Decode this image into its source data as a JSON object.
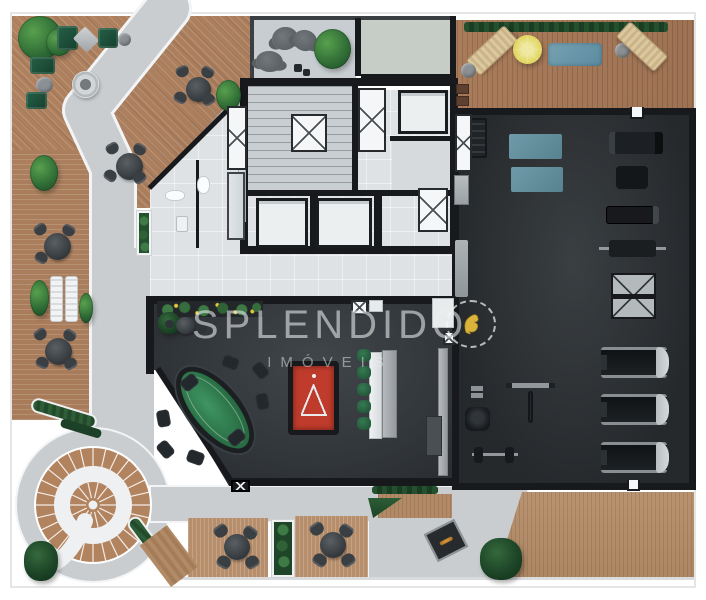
{
  "watermark": {
    "title": "SPLENDIDO",
    "subtitle": "IMÓVEIS"
  },
  "palette": {
    "wood": "#ad8160",
    "path_gray": "#c9cdcf",
    "path_edge": "#f2f4f5",
    "floor_light": "#dfe3e5",
    "wall_black": "#17191c",
    "gym_floor": "#2c3134",
    "game_floor": "#35393d",
    "mat_blue": "#6b98a8",
    "pool_red": "#bf3b2b",
    "poker_green": "#2f7d4e",
    "stool_green": "#2c6445",
    "parasol_yellow": "#e5dd6d",
    "logo_gold": "#d9b33c",
    "hedge_green": "#2a5733",
    "water_blue": "#76a2b2"
  },
  "sprites": [
    {
      "t": "plant",
      "x": 18,
      "y": 16,
      "w": 44,
      "h": 44
    },
    {
      "t": "plant",
      "x": 46,
      "y": 28,
      "w": 26,
      "h": 28
    },
    {
      "t": "chair-green",
      "x": 57,
      "y": 26,
      "w": 21,
      "h": 24
    },
    {
      "t": "pouf-d",
      "x": 76,
      "y": 31,
      "w": 20,
      "h": 17,
      "r": 45
    },
    {
      "t": "chair-green",
      "x": 98,
      "y": 28,
      "w": 20,
      "h": 20
    },
    {
      "t": "pouf",
      "x": 118,
      "y": 33,
      "w": 13,
      "h": 13
    },
    {
      "t": "chair-green",
      "x": 30,
      "y": 57,
      "w": 25,
      "h": 17
    },
    {
      "t": "pouf",
      "x": 36,
      "y": 77,
      "w": 17,
      "h": 16
    },
    {
      "t": "chair-green",
      "x": 26,
      "y": 92,
      "w": 21,
      "h": 17
    },
    {
      "t": "firering",
      "x": 72,
      "y": 71,
      "w": 27,
      "h": 27
    },
    {
      "t": "table-dark",
      "x": 186,
      "y": 77,
      "w": 25,
      "h": 25
    },
    {
      "t": "chair-dark",
      "x": 176,
      "y": 66,
      "w": 13,
      "h": 11,
      "r": -25
    },
    {
      "t": "chair-dark",
      "x": 201,
      "y": 67,
      "w": 13,
      "h": 11,
      "r": 30
    },
    {
      "t": "chair-dark",
      "x": 174,
      "y": 92,
      "w": 13,
      "h": 11,
      "r": 210
    },
    {
      "t": "chair-dark",
      "x": 202,
      "y": 94,
      "w": 13,
      "h": 11,
      "r": 150
    },
    {
      "t": "plant",
      "x": 216,
      "y": 80,
      "w": 25,
      "h": 31
    },
    {
      "t": "table-dark",
      "x": 116,
      "y": 153,
      "w": 27,
      "h": 27
    },
    {
      "t": "chair-dark",
      "x": 106,
      "y": 143,
      "w": 13,
      "h": 11,
      "r": -30
    },
    {
      "t": "chair-dark",
      "x": 133,
      "y": 144,
      "w": 13,
      "h": 11,
      "r": 30
    },
    {
      "t": "chair-dark",
      "x": 104,
      "y": 170,
      "w": 13,
      "h": 11,
      "r": 215
    },
    {
      "t": "chair-dark",
      "x": 133,
      "y": 172,
      "w": 13,
      "h": 11,
      "r": 145
    },
    {
      "t": "plant",
      "x": 30,
      "y": 155,
      "w": 28,
      "h": 36
    },
    {
      "t": "table-dark",
      "x": 44,
      "y": 233,
      "w": 27,
      "h": 27
    },
    {
      "t": "chair-dark",
      "x": 34,
      "y": 224,
      "w": 13,
      "h": 11,
      "r": -35
    },
    {
      "t": "chair-dark",
      "x": 62,
      "y": 225,
      "w": 13,
      "h": 11,
      "r": 30
    },
    {
      "t": "chair-dark",
      "x": 35,
      "y": 252,
      "w": 13,
      "h": 11,
      "r": 210
    },
    {
      "t": "plant",
      "x": 30,
      "y": 280,
      "w": 19,
      "h": 36
    },
    {
      "t": "lounger-w",
      "x": 50,
      "y": 276,
      "w": 13,
      "h": 46
    },
    {
      "t": "lounger-w",
      "x": 65,
      "y": 276,
      "w": 13,
      "h": 46
    },
    {
      "t": "plant",
      "x": 79,
      "y": 293,
      "w": 14,
      "h": 30
    },
    {
      "t": "table-dark",
      "x": 45,
      "y": 338,
      "w": 27,
      "h": 27
    },
    {
      "t": "chair-dark",
      "x": 34,
      "y": 329,
      "w": 13,
      "h": 11,
      "r": -35
    },
    {
      "t": "chair-dark",
      "x": 63,
      "y": 330,
      "w": 13,
      "h": 11,
      "r": 35
    },
    {
      "t": "chair-dark",
      "x": 36,
      "y": 357,
      "w": 13,
      "h": 11,
      "r": 205
    },
    {
      "t": "chair-dark",
      "x": 64,
      "y": 358,
      "w": 13,
      "h": 11,
      "r": 150
    },
    {
      "t": "hedge-planter",
      "x": 136,
      "y": 210,
      "w": 16,
      "h": 46
    },
    {
      "t": "chair-round",
      "x": 272,
      "y": 27,
      "w": 26,
      "h": 23,
      "r": -10
    },
    {
      "t": "chair-round",
      "x": 293,
      "y": 30,
      "w": 24,
      "h": 21,
      "r": 15
    },
    {
      "t": "chair-round",
      "x": 256,
      "y": 51,
      "w": 27,
      "h": 21,
      "r": 5
    },
    {
      "t": "plant",
      "x": 314,
      "y": 29,
      "w": 37,
      "h": 40
    },
    {
      "t": "dot-dark",
      "x": 294,
      "y": 64,
      "w": 8,
      "h": 8
    },
    {
      "t": "dot-dark",
      "x": 303,
      "y": 69,
      "w": 7,
      "h": 7
    },
    {
      "t": "hedge-strip",
      "x": 464,
      "y": 22,
      "w": 204,
      "h": 10
    },
    {
      "t": "lounger-beige",
      "x": 466,
      "y": 40,
      "w": 52,
      "h": 21,
      "r": -43
    },
    {
      "t": "pouf",
      "x": 461,
      "y": 63,
      "w": 15,
      "h": 15
    },
    {
      "t": "parasol",
      "x": 513,
      "y": 35,
      "w": 29,
      "h": 29
    },
    {
      "t": "mat-pool",
      "x": 548,
      "y": 43,
      "w": 54,
      "h": 23
    },
    {
      "t": "pouf",
      "x": 615,
      "y": 43,
      "w": 15,
      "h": 15
    },
    {
      "t": "lounger-beige",
      "x": 616,
      "y": 36,
      "w": 52,
      "h": 21,
      "r": 43
    },
    {
      "t": "matbrown",
      "x": 456,
      "y": 84,
      "w": 13,
      "h": 10
    },
    {
      "t": "matbrown",
      "x": 456,
      "y": 96,
      "w": 13,
      "h": 10
    },
    {
      "t": "rack-dumbbell",
      "x": 459,
      "y": 118,
      "w": 28,
      "h": 40
    },
    {
      "t": "mat-blue",
      "x": 509,
      "y": 134,
      "w": 53,
      "h": 25
    },
    {
      "t": "mat-blue",
      "x": 511,
      "y": 167,
      "w": 52,
      "h": 25
    },
    {
      "t": "xbox",
      "x": 455,
      "y": 114,
      "w": 17,
      "h": 58
    },
    {
      "t": "cabinet",
      "x": 454,
      "y": 175,
      "w": 15,
      "h": 30
    },
    {
      "t": "bench-wall",
      "x": 455,
      "y": 240,
      "w": 13,
      "h": 57
    },
    {
      "t": "machine-a",
      "x": 609,
      "y": 132,
      "w": 54,
      "h": 22
    },
    {
      "t": "machine-b",
      "x": 616,
      "y": 166,
      "w": 32,
      "h": 23
    },
    {
      "t": "rower",
      "x": 606,
      "y": 206,
      "w": 53,
      "h": 18
    },
    {
      "t": "benchpress",
      "x": 599,
      "y": 234,
      "w": 67,
      "h": 29
    },
    {
      "t": "elliptical",
      "x": 611,
      "y": 273,
      "w": 45,
      "h": 46
    },
    {
      "t": "treadmill",
      "x": 601,
      "y": 347,
      "w": 66,
      "h": 31
    },
    {
      "t": "treadmill",
      "x": 601,
      "y": 394,
      "w": 66,
      "h": 31
    },
    {
      "t": "treadmill",
      "x": 601,
      "y": 442,
      "w": 66,
      "h": 31
    },
    {
      "t": "rack-t",
      "x": 506,
      "y": 381,
      "w": 49,
      "h": 46
    },
    {
      "t": "db",
      "x": 467,
      "y": 386,
      "w": 20,
      "h": 5
    },
    {
      "t": "db",
      "x": 467,
      "y": 393,
      "w": 20,
      "h": 5
    },
    {
      "t": "machine-c",
      "x": 465,
      "y": 407,
      "w": 25,
      "h": 24
    },
    {
      "t": "barbell-bench",
      "x": 472,
      "y": 440,
      "w": 46,
      "h": 29
    },
    {
      "t": "door-notch",
      "x": 630,
      "y": 107,
      "w": 14,
      "h": 12
    },
    {
      "t": "door-notch",
      "x": 627,
      "y": 480,
      "w": 13,
      "h": 11
    },
    {
      "t": "planter-strip",
      "x": 157,
      "y": 301,
      "w": 106,
      "h": 16
    },
    {
      "t": "plant-dark",
      "x": 158,
      "y": 312,
      "w": 22,
      "h": 22
    },
    {
      "t": "table-dark",
      "x": 176,
      "y": 317,
      "w": 19,
      "h": 17
    },
    {
      "t": "stool-dark",
      "x": 165,
      "y": 320,
      "w": 9,
      "h": 8
    },
    {
      "t": "stool-dark",
      "x": 197,
      "y": 324,
      "w": 10,
      "h": 9
    },
    {
      "t": "poker-table",
      "x": 189,
      "y": 358,
      "w": 52,
      "h": 104,
      "r": -40
    },
    {
      "t": "chair-dark2",
      "x": 252,
      "y": 364,
      "w": 17,
      "h": 13,
      "r": 50
    },
    {
      "t": "chair-dark2",
      "x": 254,
      "y": 395,
      "w": 17,
      "h": 13,
      "r": 80
    },
    {
      "t": "chair-dark2",
      "x": 228,
      "y": 431,
      "w": 17,
      "h": 13,
      "r": 140
    },
    {
      "t": "chair-dark2",
      "x": 187,
      "y": 451,
      "w": 17,
      "h": 13,
      "r": 200
    },
    {
      "t": "chair-dark2",
      "x": 157,
      "y": 443,
      "w": 17,
      "h": 13,
      "r": 230
    },
    {
      "t": "chair-dark2",
      "x": 155,
      "y": 412,
      "w": 17,
      "h": 13,
      "r": 260
    },
    {
      "t": "chair-dark2",
      "x": 181,
      "y": 376,
      "w": 17,
      "h": 13,
      "r": 320
    },
    {
      "t": "chair-dark2",
      "x": 222,
      "y": 356,
      "w": 17,
      "h": 13,
      "r": 20
    },
    {
      "t": "pool-table",
      "x": 288,
      "y": 361,
      "w": 51,
      "h": 74
    },
    {
      "t": "counter-light",
      "x": 369,
      "y": 352,
      "w": 13,
      "h": 87
    },
    {
      "t": "counter-gray",
      "x": 382,
      "y": 350,
      "w": 15,
      "h": 88
    },
    {
      "t": "stool-green",
      "x": 357,
      "y": 349,
      "w": 14,
      "h": 13
    },
    {
      "t": "stool-green",
      "x": 357,
      "y": 366,
      "w": 14,
      "h": 13
    },
    {
      "t": "stool-green",
      "x": 357,
      "y": 383,
      "w": 14,
      "h": 13
    },
    {
      "t": "stool-green",
      "x": 357,
      "y": 400,
      "w": 14,
      "h": 13
    },
    {
      "t": "stool-green",
      "x": 357,
      "y": 417,
      "w": 14,
      "h": 13
    },
    {
      "t": "xbox",
      "x": 351,
      "y": 300,
      "w": 17,
      "h": 15
    },
    {
      "t": "lightbox",
      "x": 369,
      "y": 300,
      "w": 14,
      "h": 12
    },
    {
      "t": "lightbox",
      "x": 432,
      "y": 298,
      "w": 22,
      "h": 30
    },
    {
      "t": "xbox",
      "x": 443,
      "y": 331,
      "w": 12,
      "h": 14
    },
    {
      "t": "counter-gray",
      "x": 438,
      "y": 348,
      "w": 10,
      "h": 128
    },
    {
      "t": "sideboard",
      "x": 426,
      "y": 416,
      "w": 16,
      "h": 40
    },
    {
      "t": "xbox-dark",
      "x": 231,
      "y": 480,
      "w": 19,
      "h": 12
    },
    {
      "t": "hedge",
      "x": 30,
      "y": 406,
      "w": 68,
      "h": 15,
      "r": 17
    },
    {
      "t": "hedge-dark",
      "x": 60,
      "y": 424,
      "w": 42,
      "h": 9,
      "r": 17
    },
    {
      "t": "hedge",
      "x": 142,
      "y": 512,
      "w": 15,
      "h": 62,
      "r": -37
    },
    {
      "t": "wood-piece",
      "x": 152,
      "y": 530,
      "w": 34,
      "h": 52,
      "r": -37
    },
    {
      "t": "planterbox",
      "x": 271,
      "y": 519,
      "w": 24,
      "h": 59
    },
    {
      "t": "plant-dark",
      "x": 24,
      "y": 541,
      "w": 34,
      "h": 40
    },
    {
      "t": "table-dark",
      "x": 224,
      "y": 534,
      "w": 26,
      "h": 26
    },
    {
      "t": "chair-dark",
      "x": 214,
      "y": 525,
      "w": 14,
      "h": 12,
      "r": -35
    },
    {
      "t": "chair-dark",
      "x": 243,
      "y": 527,
      "w": 14,
      "h": 12,
      "r": 35
    },
    {
      "t": "chair-dark",
      "x": 217,
      "y": 556,
      "w": 14,
      "h": 12,
      "r": 210
    },
    {
      "t": "chair-dark",
      "x": 245,
      "y": 556,
      "w": 14,
      "h": 12,
      "r": 150
    },
    {
      "t": "table-dark",
      "x": 320,
      "y": 532,
      "w": 26,
      "h": 26
    },
    {
      "t": "chair-dark",
      "x": 310,
      "y": 523,
      "w": 14,
      "h": 12,
      "r": -35
    },
    {
      "t": "chair-dark",
      "x": 339,
      "y": 525,
      "w": 14,
      "h": 12,
      "r": 35
    },
    {
      "t": "chair-dark",
      "x": 313,
      "y": 554,
      "w": 14,
      "h": 12,
      "r": 215
    },
    {
      "t": "chair-dark",
      "x": 341,
      "y": 554,
      "w": 14,
      "h": 12,
      "r": 145
    },
    {
      "t": "hedge-strip",
      "x": 372,
      "y": 486,
      "w": 66,
      "h": 8
    },
    {
      "t": "tri-green",
      "x": 368,
      "y": 498,
      "w": 34,
      "h": 20
    },
    {
      "t": "firetable",
      "x": 429,
      "y": 525,
      "w": 34,
      "h": 31,
      "r": -27
    },
    {
      "t": "plant-dark",
      "x": 480,
      "y": 538,
      "w": 42,
      "h": 42
    },
    {
      "t": "toilet",
      "x": 165,
      "y": 190,
      "w": 20,
      "h": 11
    },
    {
      "t": "toilet",
      "x": 197,
      "y": 176,
      "w": 13,
      "h": 18
    },
    {
      "t": "sink",
      "x": 176,
      "y": 216,
      "w": 12,
      "h": 16
    },
    {
      "t": "sink",
      "x": 228,
      "y": 226,
      "w": 12,
      "h": 12
    },
    {
      "t": "shelf",
      "x": 238,
      "y": 166,
      "w": 8,
      "h": 56
    },
    {
      "t": "xbox",
      "x": 291,
      "y": 114,
      "w": 36,
      "h": 38
    },
    {
      "t": "xbox",
      "x": 358,
      "y": 88,
      "w": 28,
      "h": 64
    },
    {
      "t": "elev",
      "x": 398,
      "y": 90,
      "w": 50,
      "h": 44
    },
    {
      "t": "elev",
      "x": 256,
      "y": 198,
      "w": 52,
      "h": 50
    },
    {
      "t": "elev",
      "x": 316,
      "y": 198,
      "w": 56,
      "h": 50
    },
    {
      "t": "xbox",
      "x": 418,
      "y": 188,
      "w": 30,
      "h": 44
    },
    {
      "t": "xbox",
      "x": 227,
      "y": 106,
      "w": 20,
      "h": 64
    },
    {
      "t": "glass",
      "x": 227,
      "y": 172,
      "w": 18,
      "h": 68
    }
  ]
}
